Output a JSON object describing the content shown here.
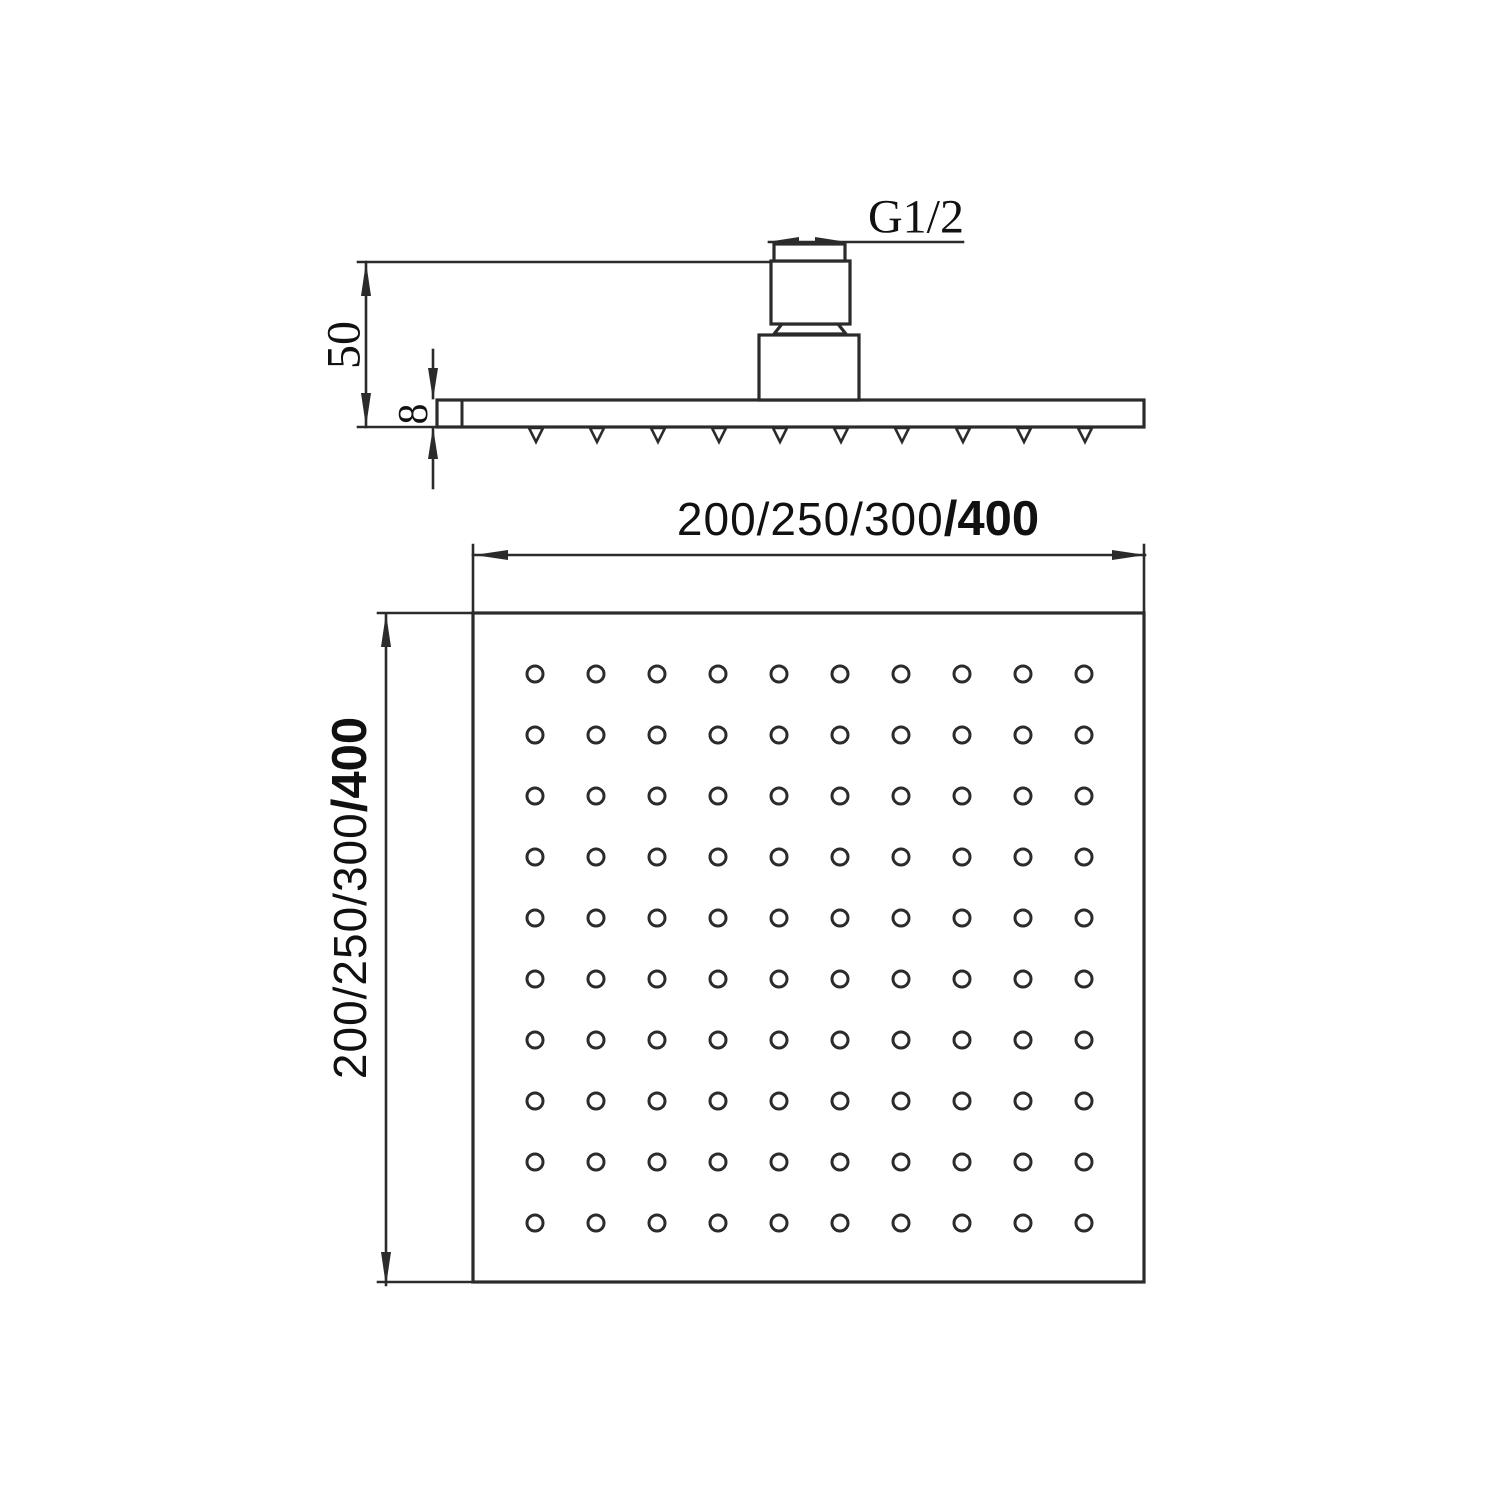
{
  "colors": {
    "line": "#2b2b2b",
    "text": "#111111",
    "bg": "#ffffff"
  },
  "side_view": {
    "thread_label": "G1/2",
    "height_label": "50",
    "thickness_label": "8",
    "nozzles": {
      "count": 10,
      "start_x": 536,
      "step_x": 61,
      "y": 427,
      "half_width": 7,
      "height": 15
    }
  },
  "bottom_view": {
    "width_label_regular": "200/250/300",
    "width_label_bold": "/400",
    "height_label_regular": "200/250/300",
    "height_label_bold": "/400",
    "holes": {
      "rows": 10,
      "cols": 10,
      "start_x": 535,
      "start_y": 674,
      "step_x": 61,
      "step_y": 61,
      "radius": 8
    }
  }
}
